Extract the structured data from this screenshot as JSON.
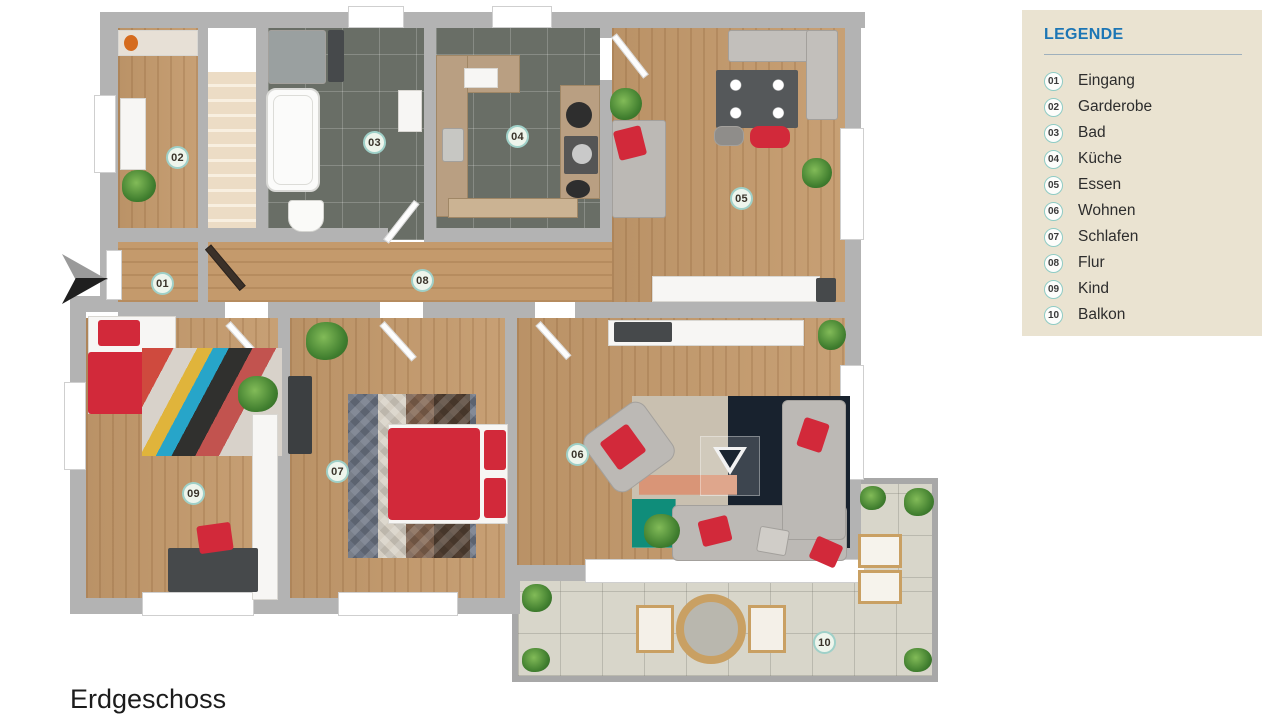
{
  "floor_label": "Erdgeschoss",
  "legend": {
    "title": "LEGENDE",
    "items": [
      {
        "num": "01",
        "label": "Eingang"
      },
      {
        "num": "02",
        "label": "Garderobe"
      },
      {
        "num": "03",
        "label": "Bad"
      },
      {
        "num": "04",
        "label": "Küche"
      },
      {
        "num": "05",
        "label": "Essen"
      },
      {
        "num": "06",
        "label": "Wohnen"
      },
      {
        "num": "07",
        "label": "Schlafen"
      },
      {
        "num": "08",
        "label": "Flur"
      },
      {
        "num": "09",
        "label": "Kind"
      },
      {
        "num": "10",
        "label": "Balkon"
      }
    ]
  },
  "colors": {
    "legend_background": "#EAE3D1",
    "legend_title_blue": "#1C76B5",
    "badge_ring_teal": "#8FCCC5",
    "wall_gray": "#B3B3B3",
    "wood_floor": "#C49A6C",
    "dark_tile": "#696E66",
    "balcony_tile": "#D8D6CA",
    "furniture_red": "#D2293A",
    "sofa_gray": "#BCB9B5"
  }
}
